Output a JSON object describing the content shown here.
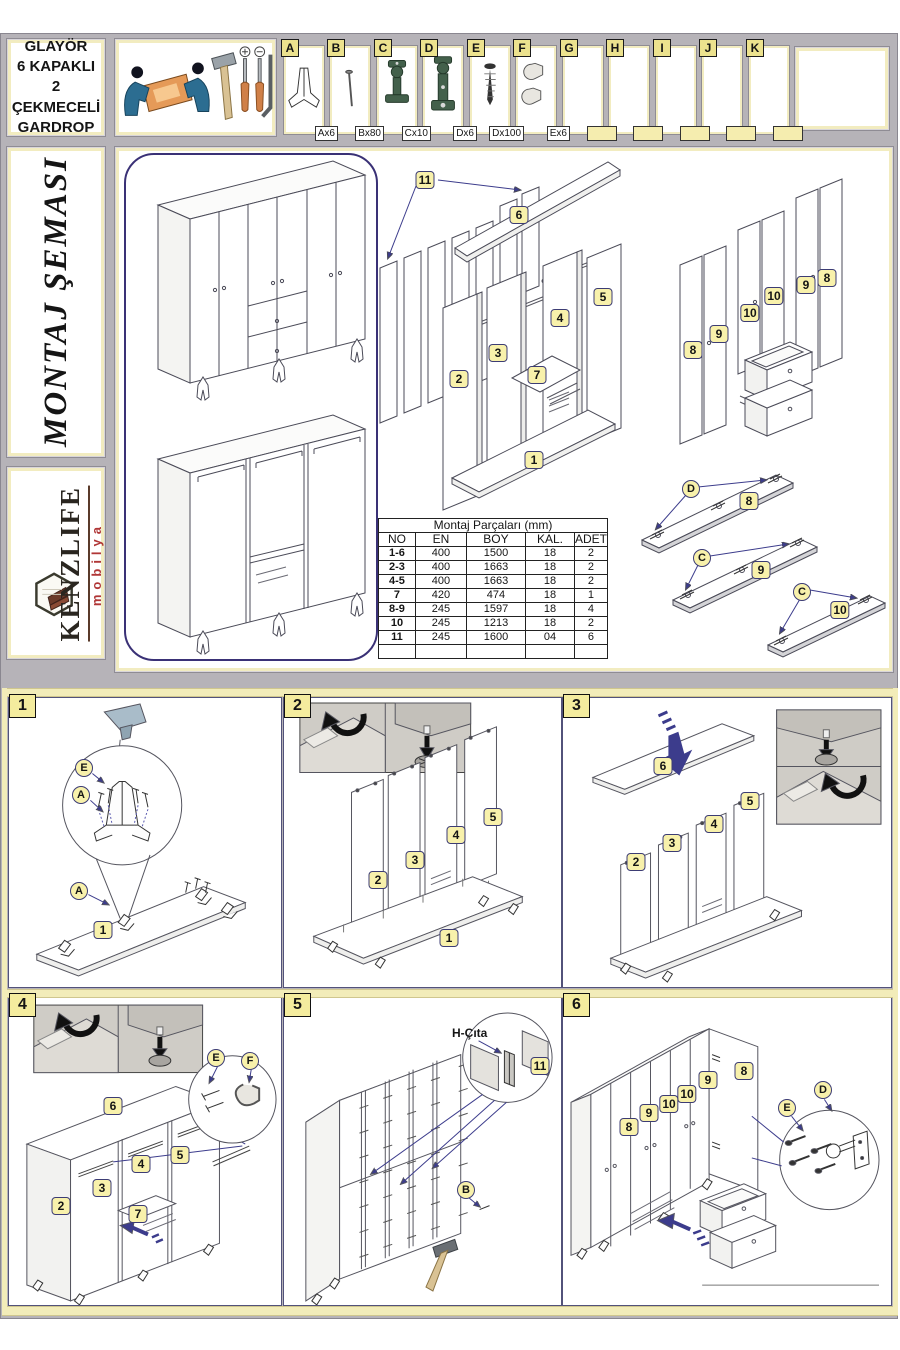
{
  "header": {
    "title_lines": [
      "GLAYÖR",
      "6 KAPAKLI",
      "2 ÇEKMECELİ",
      "GARDROP"
    ]
  },
  "hardware": {
    "letters": {
      "a": "A",
      "b": "B",
      "c": "C",
      "d": "D",
      "e": "E",
      "f": "F",
      "g": "G",
      "h": "H",
      "i": "I",
      "j": "J",
      "k": "K"
    },
    "quantities": {
      "a": "Ax6",
      "b": "Bx80",
      "c": "Cx10",
      "d": "Dx6",
      "e": "Dx100",
      "f": "Ex6"
    }
  },
  "sidebar": {
    "title": "MONTAJ ŞEMASI",
    "brand": "KENZLIFE",
    "brand_sub": "mobilya"
  },
  "parts_table": {
    "title": "Montaj Parçaları (mm)",
    "headers": [
      "NO",
      "EN",
      "BOY",
      "KAL.",
      "ADET"
    ],
    "rows": [
      [
        "1-6",
        "400",
        "1500",
        "18",
        "2"
      ],
      [
        "2-3",
        "400",
        "1663",
        "18",
        "2"
      ],
      [
        "4-5",
        "400",
        "1663",
        "18",
        "2"
      ],
      [
        "7",
        "420",
        "474",
        "18",
        "1"
      ],
      [
        "8-9",
        "245",
        "1597",
        "18",
        "4"
      ],
      [
        "10",
        "245",
        "1213",
        "18",
        "2"
      ],
      [
        "11",
        "245",
        "1600",
        "04",
        "6"
      ],
      [
        "",
        "",
        "",
        "",
        ""
      ]
    ]
  },
  "labels": {
    "p1": "1",
    "p2": "2",
    "p3": "3",
    "p4": "4",
    "p5": "5",
    "p6": "6",
    "p7": "7",
    "p8": "8",
    "p9": "9",
    "p10": "10",
    "p11": "11"
  },
  "letters": {
    "A": "A",
    "B": "B",
    "C": "C",
    "D": "D",
    "E": "E",
    "F": "F"
  },
  "steps": {
    "s1": "1",
    "s2": "2",
    "s3": "3",
    "s4": "4",
    "s5": "5",
    "s6": "6"
  },
  "notes": {
    "h_cita": "H-Çıta"
  }
}
